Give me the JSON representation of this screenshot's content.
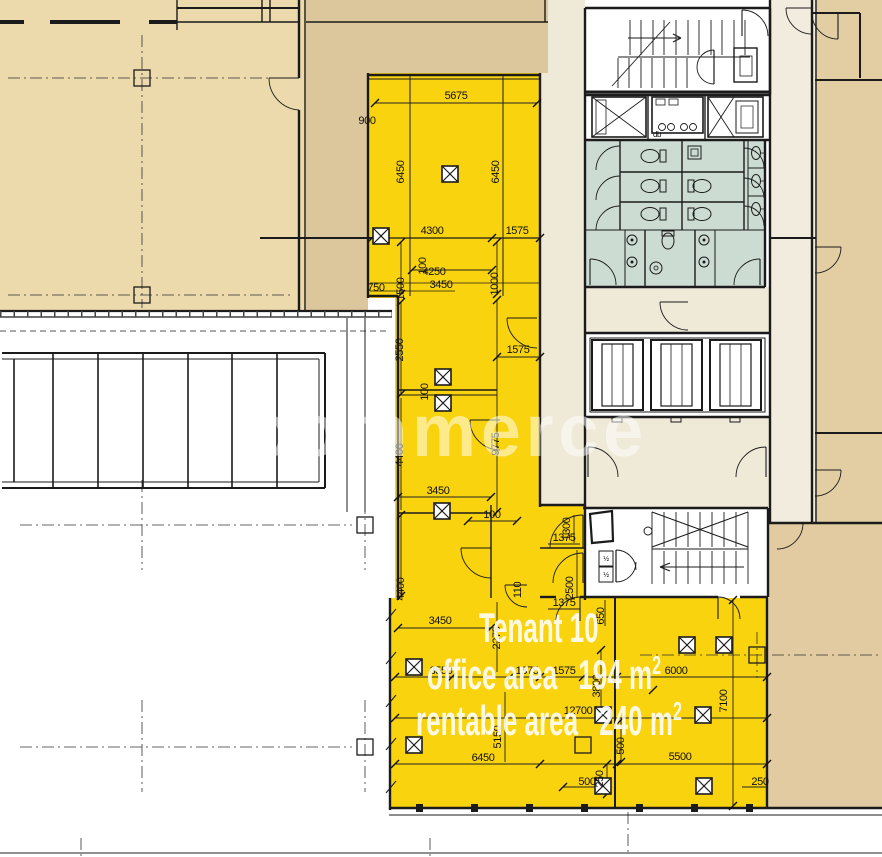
{
  "tenant": {
    "name": "Tenant 10",
    "office_label": "office area",
    "office_value": "194 m",
    "office_sup": "2",
    "rentable_label": "rentable area",
    "rentable_value": "240 m",
    "rentable_sup": "2"
  },
  "watermark": "commerce",
  "colors": {
    "tenant_yellow": "#f8d30e",
    "tan_light": "#ecd9ac",
    "tan_dark": "#dcc69b",
    "tan_right": "#e3cda3",
    "tan_bottom_right": "#e2cba0",
    "wc_teal": "#ccdcd3",
    "lobby_cream": "#efe9d8",
    "corridor_cream": "#f2ecdf",
    "line": "#1b1b1b"
  },
  "dimensions": [
    {
      "t": "5675",
      "x": 456,
      "y": 99
    },
    {
      "t": "900",
      "x": 367,
      "y": 124
    },
    {
      "t": "6450",
      "x": 404,
      "y": 172,
      "r": -90
    },
    {
      "t": "6450",
      "x": 499,
      "y": 172,
      "r": -90
    },
    {
      "t": "4300",
      "x": 432,
      "y": 234
    },
    {
      "t": "1575",
      "x": 517,
      "y": 234
    },
    {
      "t": "100",
      "x": 426,
      "y": 266,
      "r": -90
    },
    {
      "t": "4250",
      "x": 434,
      "y": 275
    },
    {
      "t": "3450",
      "x": 441,
      "y": 288
    },
    {
      "t": "750",
      "x": 376,
      "y": 291
    },
    {
      "t": "1500",
      "x": 404,
      "y": 289,
      "r": -90
    },
    {
      "t": "1000",
      "x": 498,
      "y": 284,
      "r": -90
    },
    {
      "t": "2550",
      "x": 403,
      "y": 350,
      "r": -90
    },
    {
      "t": "1575",
      "x": 518,
      "y": 353
    },
    {
      "t": "100",
      "x": 428,
      "y": 392,
      "r": -90
    },
    {
      "t": "9775",
      "x": 499,
      "y": 444,
      "r": -90
    },
    {
      "t": "4400",
      "x": 403,
      "y": 455,
      "r": -90
    },
    {
      "t": "3450",
      "x": 438,
      "y": 494
    },
    {
      "t": "100",
      "x": 492,
      "y": 518
    },
    {
      "t": "1300",
      "x": 570,
      "y": 529,
      "r": -90
    },
    {
      "t": "1375",
      "x": 564,
      "y": 541
    },
    {
      "t": "4400",
      "x": 404,
      "y": 589,
      "r": -90
    },
    {
      "t": "110",
      "x": 521,
      "y": 590,
      "r": -90
    },
    {
      "t": "2500",
      "x": 573,
      "y": 588,
      "r": -90
    },
    {
      "t": "1375",
      "x": 564,
      "y": 606
    },
    {
      "t": "3450",
      "x": 440,
      "y": 624
    },
    {
      "t": "650",
      "x": 604,
      "y": 616,
      "r": -90
    },
    {
      "t": "2275",
      "x": 500,
      "y": 638,
      "r": -90
    },
    {
      "t": "3550",
      "x": 441,
      "y": 674
    },
    {
      "t": "1375",
      "x": 527,
      "y": 674
    },
    {
      "t": "1575",
      "x": 564,
      "y": 674
    },
    {
      "t": "6000",
      "x": 676,
      "y": 674
    },
    {
      "t": "3800",
      "x": 600,
      "y": 686,
      "r": -90
    },
    {
      "t": "7100",
      "x": 727,
      "y": 701,
      "r": -90
    },
    {
      "t": "12700",
      "x": 578,
      "y": 714
    },
    {
      "t": "5150",
      "x": 501,
      "y": 737,
      "r": -90
    },
    {
      "t": "500",
      "x": 624,
      "y": 746,
      "r": -90
    },
    {
      "t": "6450",
      "x": 483,
      "y": 761
    },
    {
      "t": "5500",
      "x": 680,
      "y": 760
    },
    {
      "t": "250",
      "x": 603,
      "y": 779,
      "r": -90
    },
    {
      "t": "500",
      "x": 587,
      "y": 785
    },
    {
      "t": "250",
      "x": 760,
      "y": 785
    },
    {
      "t": "db",
      "x": 657,
      "y": 137,
      "s": 8
    },
    {
      "t": "½",
      "x": 606,
      "y": 561,
      "s": 7
    },
    {
      "t": "½",
      "x": 606,
      "y": 577,
      "s": 7
    }
  ]
}
